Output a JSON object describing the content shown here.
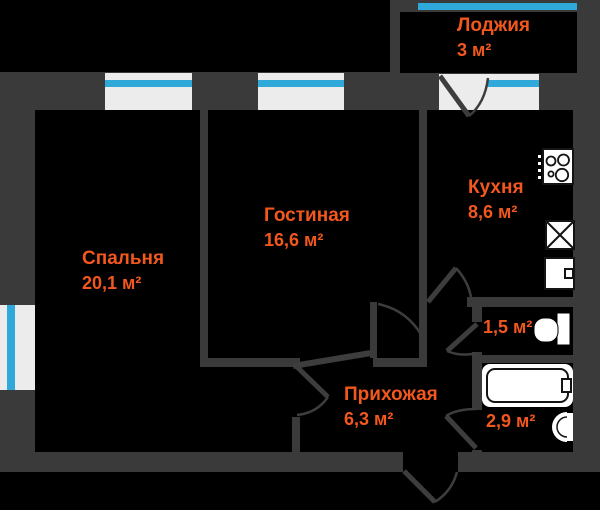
{
  "plan_title": "apartment-floor-plan",
  "rooms": [
    {
      "name": "Лоджия",
      "area": "3 м²"
    },
    {
      "name": "Спальня",
      "area": "20,1 м²"
    },
    {
      "name": "Гостиная",
      "area": "16,6 м²"
    },
    {
      "name": "Кухня",
      "area": "8,6 м²"
    },
    {
      "name": "Прихожая",
      "area": "6,3 м²"
    },
    {
      "area": "1,5 м²"
    },
    {
      "area": "2,9 м²"
    }
  ],
  "colors": {
    "background": "#000000",
    "wall": "#3a3a3a",
    "room_fill": "#000000",
    "window_frame": "#ececec",
    "glass": "#2fa9d9",
    "label_text": "#f2571d",
    "fixture": "#ffffff"
  },
  "icons": [
    "stove-icon",
    "sink-box-icon",
    "fridge-icon",
    "toilet-icon",
    "bathtub-icon",
    "washbasin-icon",
    "door-swing-icon",
    "window-icon"
  ]
}
